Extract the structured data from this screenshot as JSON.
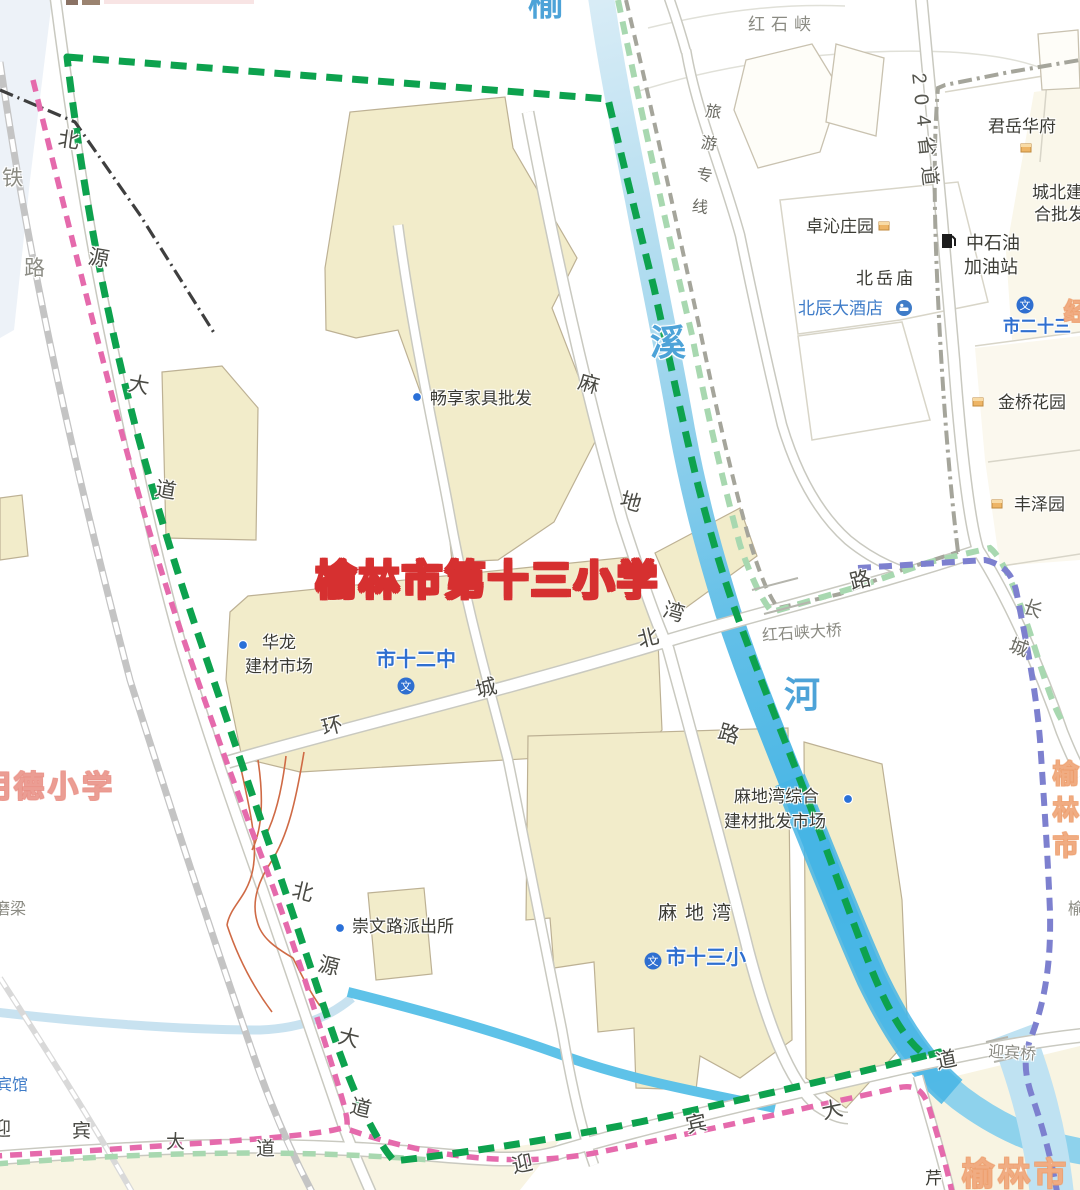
{
  "title": "榆林市第十三小学",
  "icons": {
    "school_glyph": "文"
  },
  "colors": {
    "boundary_green": "#0da24e",
    "boundary_pink": "#e56aac",
    "boundary_purple": "#7d80cf",
    "boundary_pale_green": "#a8d8b0",
    "river_blue": "#46b5e5",
    "building_fill": "#f2ecca",
    "title_red": "#d63030",
    "poi_blue_dot": "#2a70d8"
  },
  "water": {
    "char_top": "榆",
    "char_mid": "溪",
    "char_bottom": "河"
  },
  "roads": {
    "tielu": [
      "铁",
      "路"
    ],
    "beiyuan": [
      "北",
      "源",
      "大",
      "道"
    ],
    "huancheng": [
      "环",
      "城",
      "北",
      "路"
    ],
    "madiwan_rd": [
      "麻",
      "地",
      "湾",
      "路"
    ],
    "yingbin": [
      "迎",
      "宾",
      "大",
      "道"
    ],
    "s204": "204省道",
    "lvyou": "旅游专线",
    "changcheng": "长城"
  },
  "labels": {
    "hongshixia": "红石峡",
    "zhuoqin": "卓沁庄园",
    "beiyuemiao": "北岳庙",
    "beichen": "北辰大酒店",
    "junyue": "君岳华府",
    "chengbei_l1": "城北建",
    "chengbei_l2": "合批发",
    "zhongshiyou_l1": "中石油",
    "zhongshiyou_l2": "加油站",
    "shi23": "市二十三",
    "jinqiao": "金桥花园",
    "fengze": "丰泽园",
    "changxiang": "畅享家具批发",
    "hualong_l1": "华龙",
    "hualong_l2": "建材市场",
    "shi12": "市十二中",
    "hongshixia_bridge": "红石峡大桥",
    "madiwan_market_l1": "麻地湾综合",
    "madiwan_market_l2": "建材批发市场",
    "madiwan": "麻地湾",
    "shi13": "市十三小",
    "chongwen": "崇文路派出所",
    "moliang": "磨梁",
    "binguan": "宾馆",
    "mingde": "明德小学",
    "yingbinqiao": "迎宾桥",
    "yulin_right": "榆林市",
    "yulin_bottom": "榆林市",
    "yu_partial": "榆",
    "qin_partial": "芹",
    "jing_partial": "经"
  }
}
